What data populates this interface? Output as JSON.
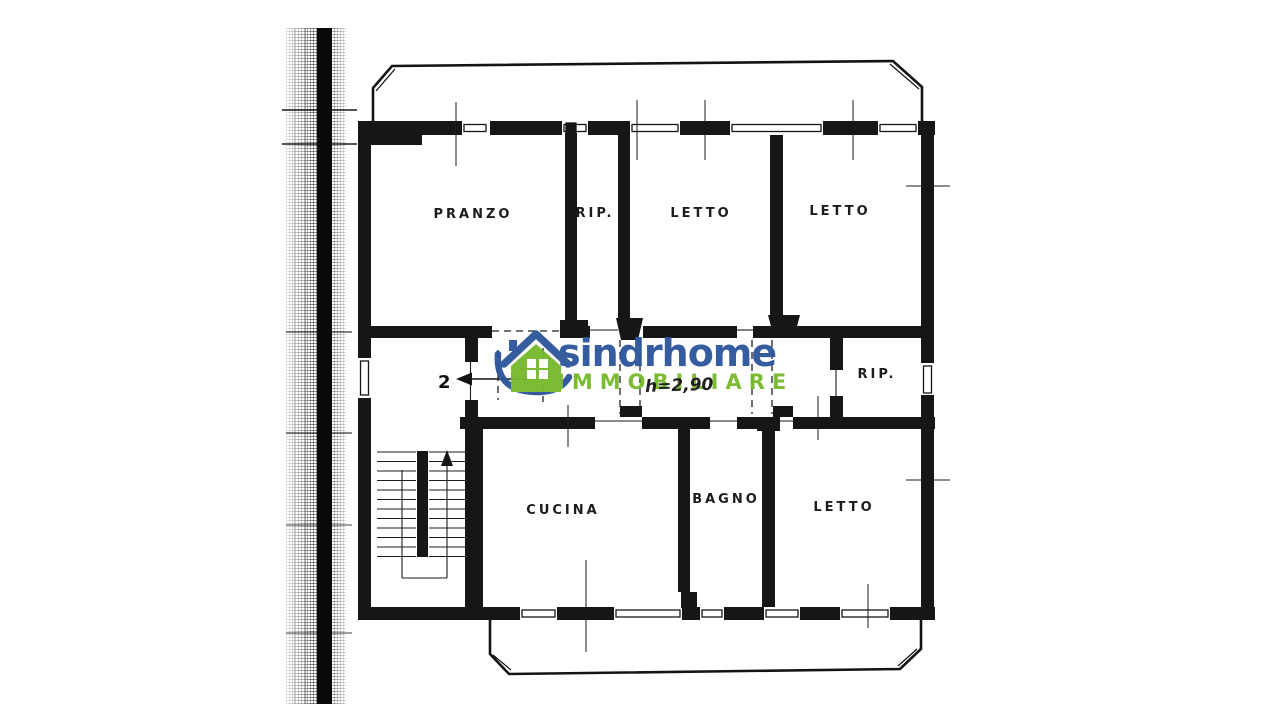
{
  "watermark": {
    "brand": "sindrhome",
    "tagline": "IMMOBILIARE",
    "brand_color": "#2a5499",
    "tagline_color": "#76b82a"
  },
  "floorplan": {
    "rooms": [
      {
        "id": "pranzo",
        "label": "PRANZO"
      },
      {
        "id": "rip-top",
        "label": "RIP."
      },
      {
        "id": "letto-top-left",
        "label": "LETTO"
      },
      {
        "id": "letto-top-right",
        "label": "LETTO"
      },
      {
        "id": "rip-right",
        "label": "RIP."
      },
      {
        "id": "cucina",
        "label": "CUCINA"
      },
      {
        "id": "bagno",
        "label": "BAGNO"
      },
      {
        "id": "letto-bottom",
        "label": "LETTO"
      }
    ],
    "annotations": {
      "ceiling_height": "h=2,90",
      "unit_number": "2"
    },
    "ink_color": "#161616"
  }
}
